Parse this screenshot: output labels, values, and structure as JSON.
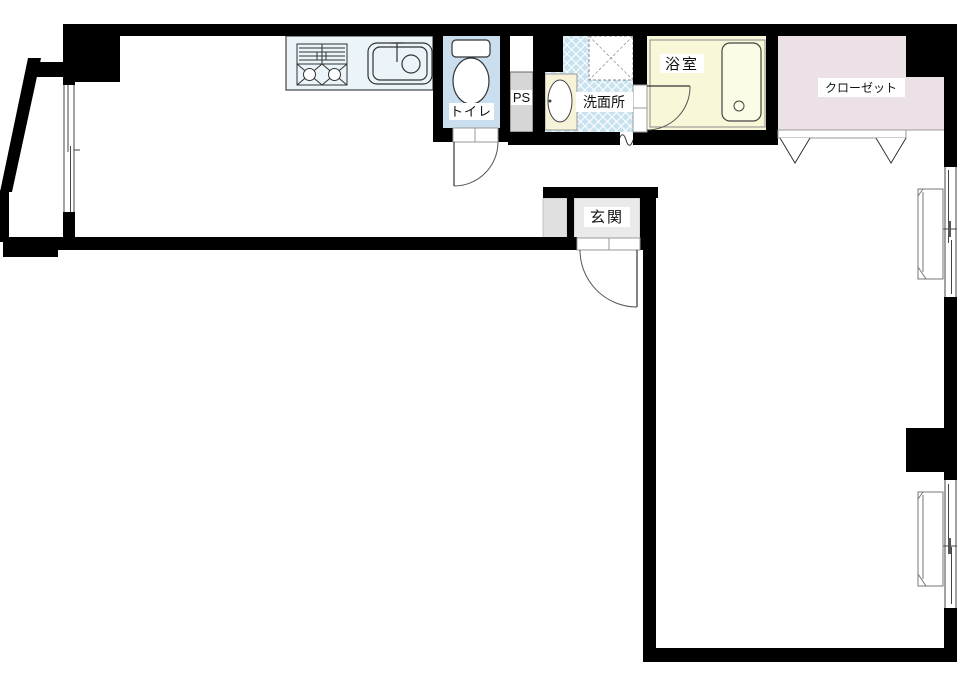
{
  "plan": {
    "type": "apartment-floor-plan",
    "rooms": {
      "toilet": "トイレ",
      "pipe_space": "PS",
      "washroom": "洗面所",
      "bathroom": "浴室",
      "closet": "クローゼット",
      "entrance": "玄関"
    },
    "colors": {
      "wall": "#000000",
      "toilet_room": "#c9dff0",
      "kitchen_counter": "#eaf4f9",
      "washroom_tile": "#c9e2ef",
      "bathroom": "#f8f7d8",
      "bathtub": "#fbfbe6",
      "basin_counter": "#f6f3d9",
      "closet": "#ece1e7",
      "entrance": "#eaeaea",
      "entrance_side": "#e0e0e0",
      "pipe_space_fill": "#d6d6d6"
    }
  }
}
